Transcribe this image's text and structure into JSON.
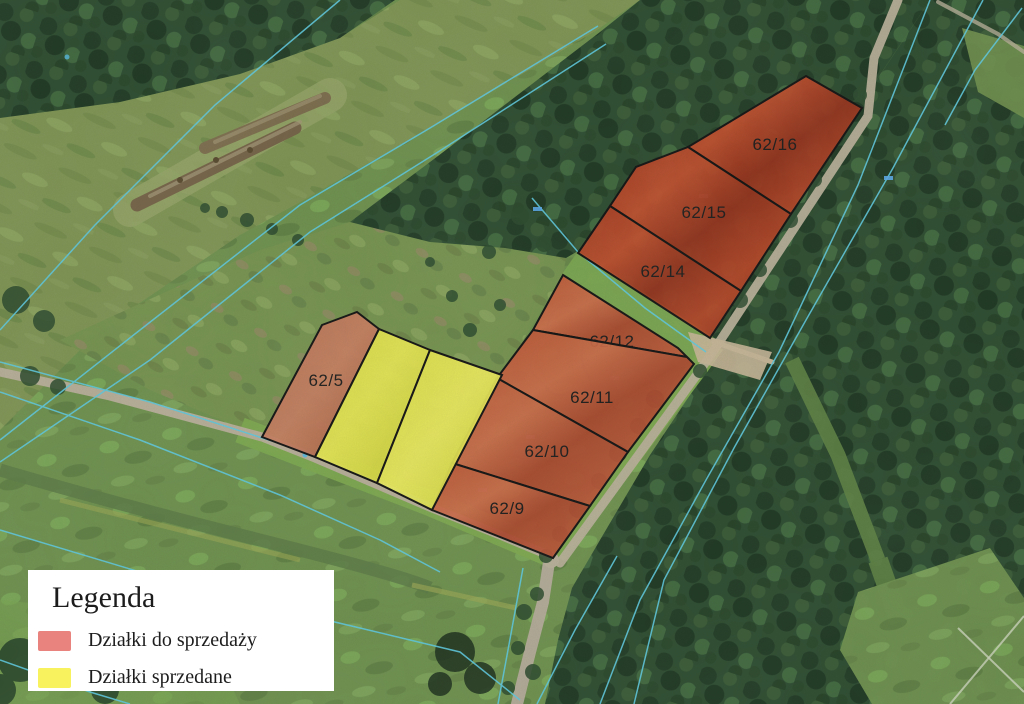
{
  "legend": {
    "title": "Legenda",
    "items": [
      {
        "key": "for_sale",
        "label": "Działki do sprzedaży",
        "color": "#e9837e"
      },
      {
        "key": "sold",
        "label": "Działki sprzedane",
        "color": "#f7f25e"
      }
    ]
  },
  "map": {
    "status_fill": {
      "for_sale": "#b5432a",
      "sold": "#d9db3f"
    },
    "outline_color": "#141414",
    "cadastral_line_color": "#5ec7dd",
    "parcels": [
      {
        "id": "62/16",
        "status": "for_sale",
        "tone": "dark",
        "points": "806,76 862,108 791,214 688,147",
        "label_x": 775,
        "label_y": 150
      },
      {
        "id": "62/15",
        "status": "for_sale",
        "tone": "dark",
        "points": "688,147 791,214 741,291 610,206 636,167",
        "label_x": 704,
        "label_y": 218
      },
      {
        "id": "62/14",
        "status": "for_sale",
        "tone": "dark",
        "points": "610,206 741,291 710,338 578,253",
        "label_x": 663,
        "label_y": 277
      },
      {
        "id": "62/12",
        "status": "for_sale",
        "tone": "mid",
        "points": "563,275 678,348 687,357 533,330",
        "label_x": 612,
        "label_y": 347
      },
      {
        "id": "62/11",
        "status": "for_sale",
        "tone": "mid",
        "points": "533,330 687,357 694,364 628,452 497,378",
        "label_x": 592,
        "label_y": 403
      },
      {
        "id": "62/10",
        "status": "for_sale",
        "tone": "mid",
        "points": "497,378 628,452 590,506 452,463",
        "label_x": 547,
        "label_y": 457
      },
      {
        "id": "62/9",
        "status": "for_sale",
        "tone": "mid",
        "points": "452,463 590,506 553,558 432,510",
        "label_x": 507,
        "label_y": 514
      },
      {
        "id": "62/5",
        "status": "for_sale",
        "tone": "light",
        "points": "357,312 379,329 315,457 262,437 322,325",
        "label_x": 326,
        "label_y": 386
      },
      {
        "id": "",
        "status": "sold",
        "tone": "a",
        "points": "379,329 430,350 377,483 315,457",
        "label_x": 0,
        "label_y": 0
      },
      {
        "id": "",
        "status": "sold",
        "tone": "b",
        "points": "430,350 502,375 432,510 377,483",
        "label_x": 0,
        "label_y": 0
      }
    ]
  }
}
